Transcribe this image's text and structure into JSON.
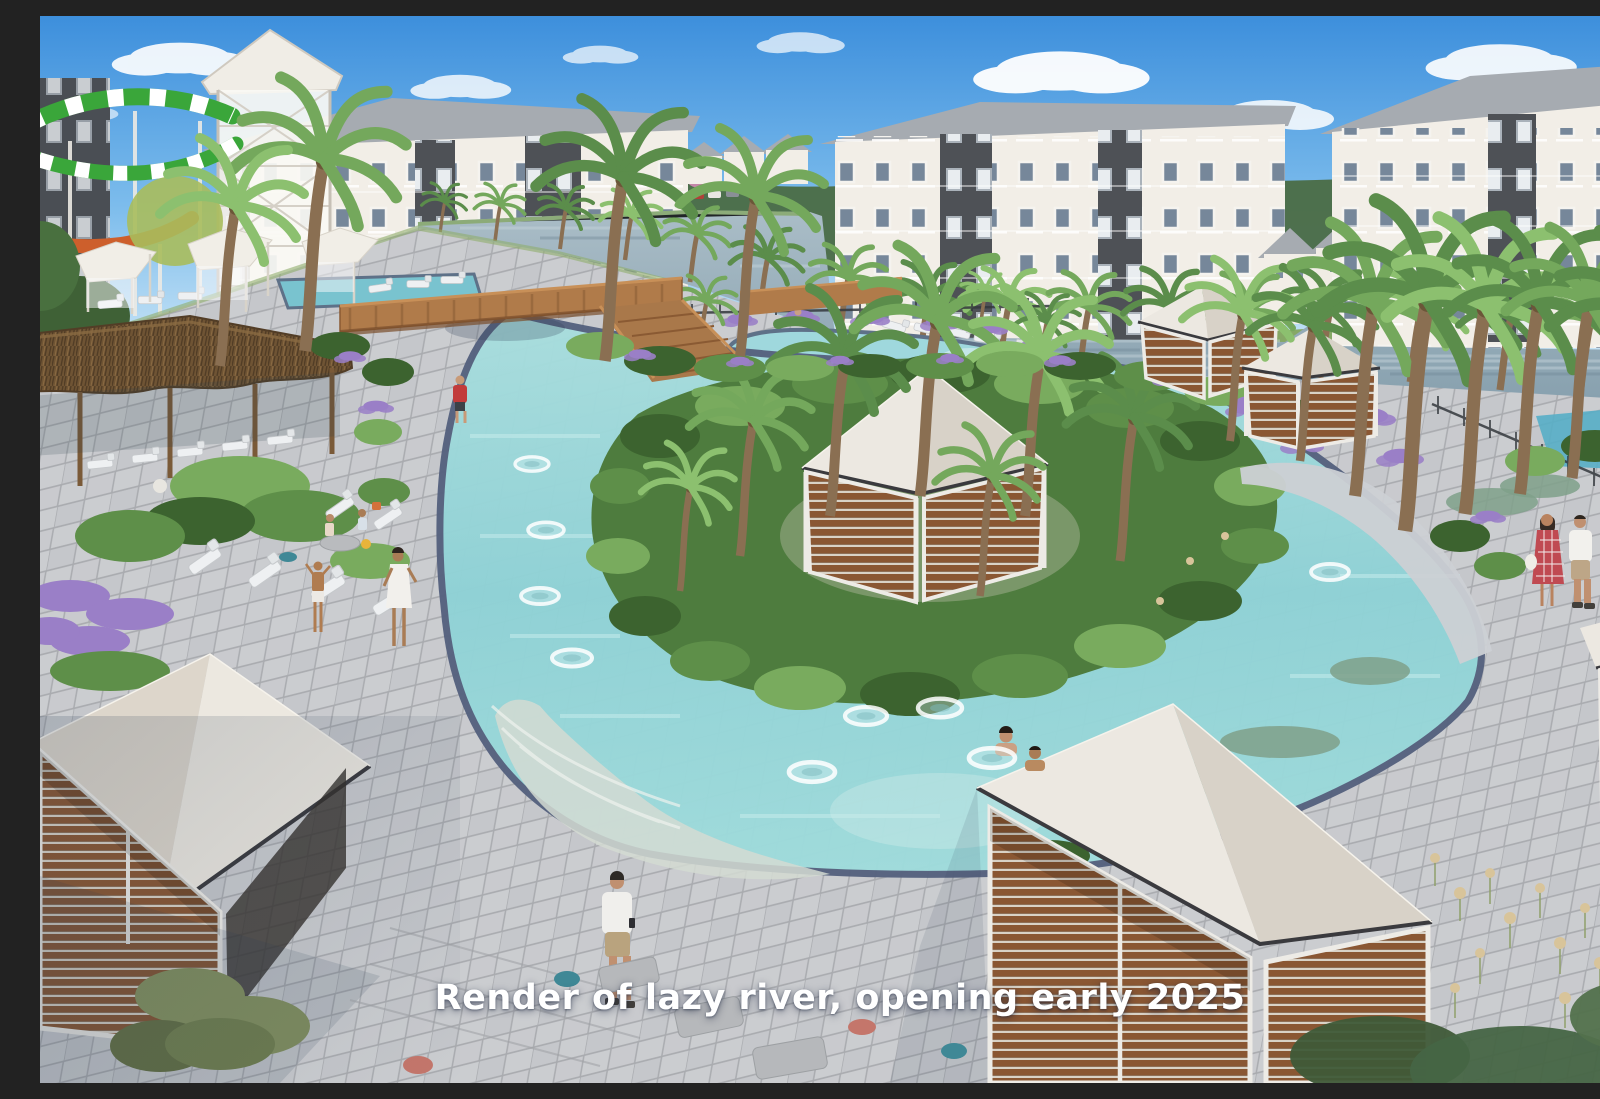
{
  "caption": {
    "text": "Render of lazy river, opening early 2025"
  },
  "scene": {
    "type": "architectural-render",
    "elements": [
      "sky",
      "clouds",
      "apartment-buildings",
      "water-slide",
      "lake",
      "palm-trees",
      "lazy-river",
      "inner-tubes",
      "island",
      "cabanas",
      "pool",
      "pool-deck",
      "tiki-hut",
      "lounge-chairs",
      "wood-bridge",
      "swimmers",
      "pedestrians",
      "purple-flowers"
    ]
  },
  "palette": {
    "sky-top": "#3d8fdc",
    "sky-mid": "#7cbcec",
    "sky-low": "#e4f1fa",
    "cloud": "#ffffff",
    "treeline": "#4b6b45",
    "bldg-white": "#f2eee7",
    "bldg-shade": "#ddd8cf",
    "bldg-dark": "#4e5156",
    "roof": "#a6abb1",
    "lake": "#93a9b6",
    "palm-green": "#5b8d4b",
    "palm-green-light": "#74a85c",
    "trunk": "#8a6f52",
    "river": "#8fd2d6",
    "river-light": "#bde7e6",
    "tile-edge": "#56627f",
    "island-green": "#4e7c3e",
    "bush-dark": "#3c632f",
    "bush-light": "#79ab5e",
    "deck": "#cbcdd0",
    "deck-line": "#a9abaf",
    "wood": "#8a5733",
    "wood-dark": "#6e4526",
    "frame": "#edebe6",
    "roof-white": "#ece8e1",
    "roof-shade": "#d8d2c8",
    "thatch": "#6f5434",
    "purple": "#9a7fc7",
    "teal": "#3f8896",
    "coral": "#c4766b",
    "slide-green": "#3aa63a",
    "slide-orange": "#cd5f2c",
    "caption": "#ffffff"
  }
}
